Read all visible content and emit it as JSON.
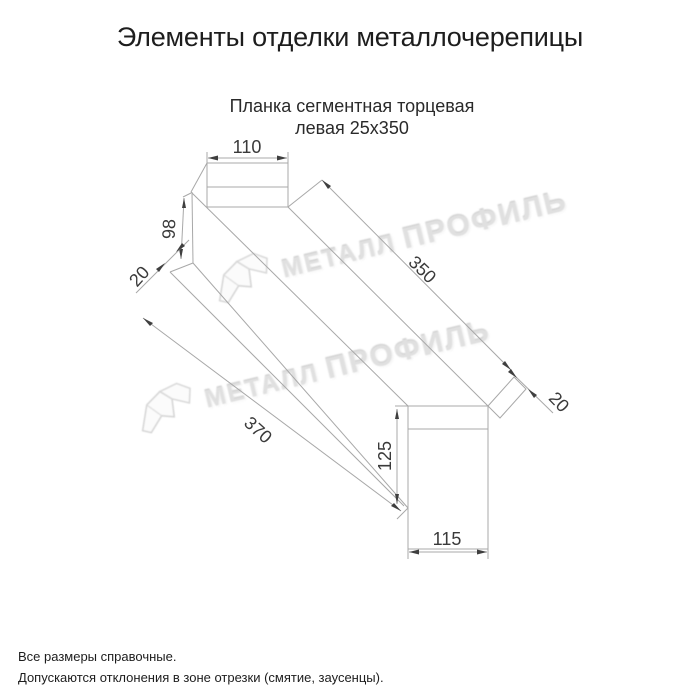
{
  "page": {
    "title": "Элементы отделки металлочерепицы",
    "product_line1": "Планка сегментная торцевая",
    "product_line2": "левая 25х350",
    "notes": [
      "Все размеры справочные.",
      "Допускаются отклонения в зоне отрезки (смятие, заусенцы)."
    ]
  },
  "drawing": {
    "dims": {
      "top_width_left": "110",
      "height_left": "98",
      "hem_left": "20",
      "length_top": "350",
      "length_bottom": "370",
      "hem_right": "20",
      "height_right": "125",
      "bottom_width_right": "115"
    }
  },
  "watermark": {
    "part1": "МЕТАЛЛ",
    "part2": "ПРОФИЛЬ"
  },
  "colors": {
    "line": "#a8a8a8",
    "dim_text": "#3a3a3a",
    "watermark": "#e0e0e0",
    "text": "#1d1d1d"
  }
}
